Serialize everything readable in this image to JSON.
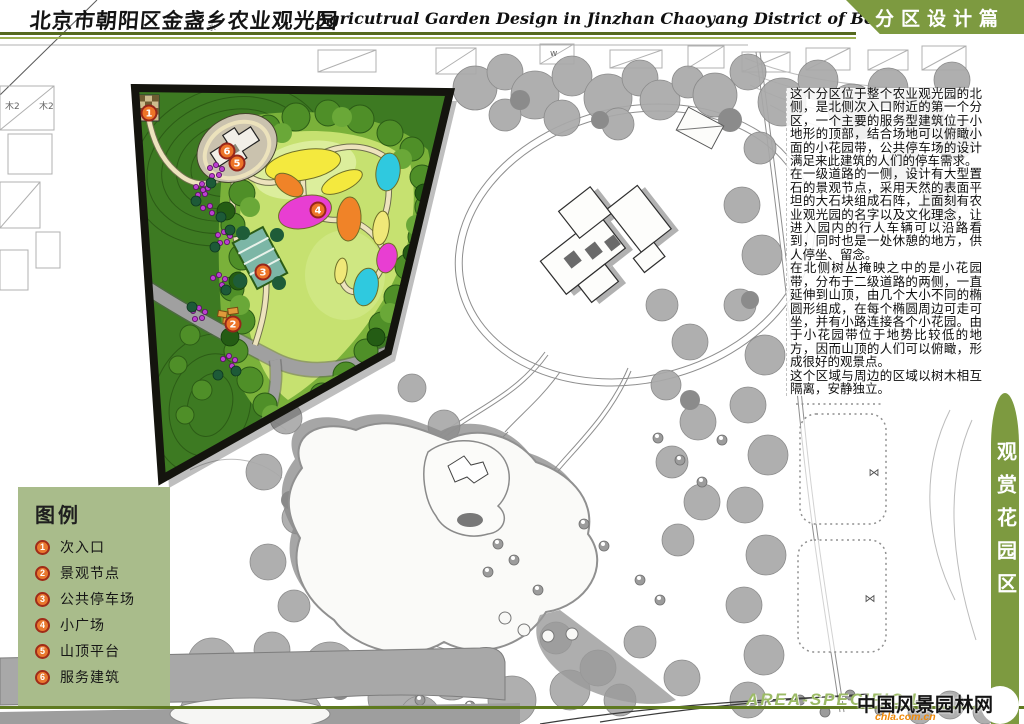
{
  "header": {
    "title_cn": "北京市朝阳区金盏乡农业观光园",
    "title_en": "Agricutrual Garden Design in Jinzhan Chaoyang District of Beijing",
    "banner": "分区设计篇"
  },
  "article": {
    "paragraphs": [
      "这个分区位于整个农业观光园的北侧，是北侧次入口附近的第一个分区，一个主要的服务型建筑位于小地形的顶部，结合场地可以俯瞰小面的小花园带，公共停车场的设计满足来此建筑的人们的停车需求。",
      "在一级道路的一侧，设计有大型置石的景观节点，采用天然的表面平坦的大石块组成石阵，上面刻有农业观光园的名字以及文化理念，让进入园内的行人车辆可以沿路看到，同时也是一处休憩的地方，供人停坐、留念。",
      "在北侧树丛掩映之中的是小花园带，分布于二级道路的两侧，一直延伸到山顶，由几个大小不同的椭圆形组成，在每个椭圆周边可走可坐，并有小路连接各个小花园。由于小花园带位于地势比较低的地方，因而山顶的人们可以俯瞰，形成很好的观景点。",
      "这个区域与周边的区域以树木相互隔离，安静独立。"
    ]
  },
  "legend": {
    "title": "图例",
    "items": [
      {
        "num": "1",
        "label": "次入口"
      },
      {
        "num": "2",
        "label": "景观节点"
      },
      {
        "num": "3",
        "label": "公共停车场"
      },
      {
        "num": "4",
        "label": "小广场"
      },
      {
        "num": "5",
        "label": "山顶平台"
      },
      {
        "num": "6",
        "label": "服务建筑"
      }
    ]
  },
  "vertical_banner": {
    "label": "观赏花园区"
  },
  "footer": {
    "caption": "AREA-SPECIFIC L",
    "watermark_title": "中国风景园林网",
    "watermark_url": "chla.com.cn",
    "page_number": "3"
  },
  "plan_labels": {
    "plot_a": "木2",
    "plot_b": "木2",
    "water": "水",
    "w_mark": "w",
    "plot_symbol": "⋈"
  },
  "colors": {
    "banner_green": "#7d9a40",
    "legend_bg": "#a9bc8b",
    "accent_line": "#5e7a20",
    "marker_orange": "#e8782e"
  }
}
